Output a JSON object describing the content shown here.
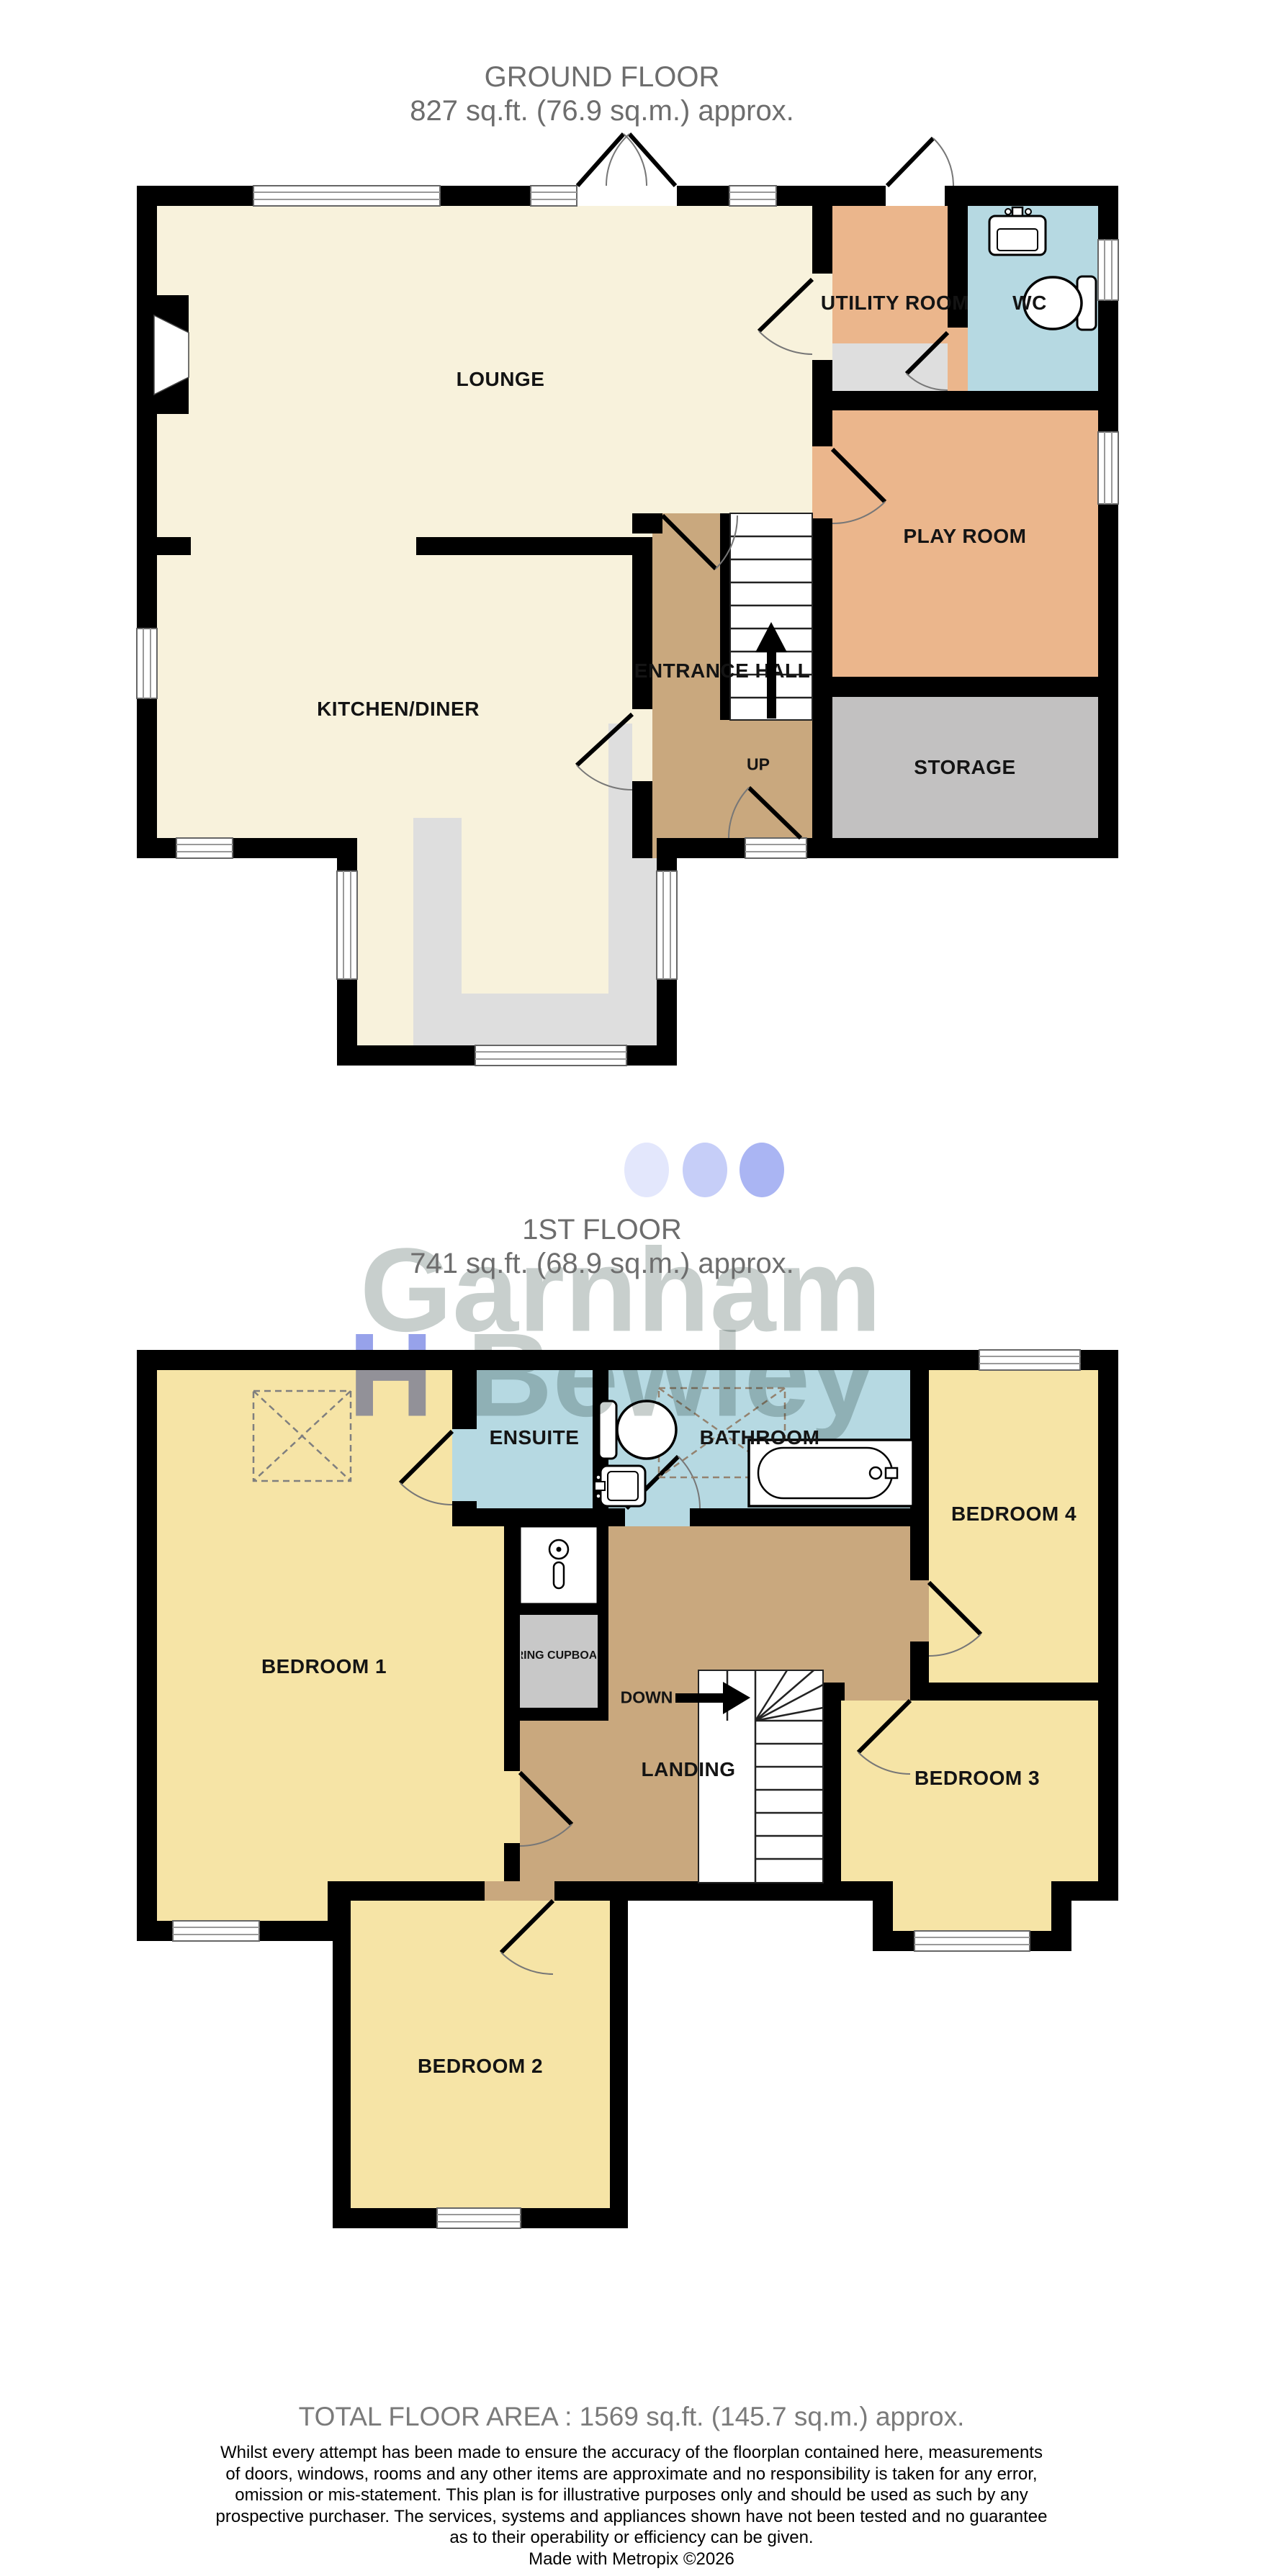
{
  "ground_floor": {
    "title": "GROUND FLOOR",
    "area": "827 sq.ft. (76.9 sq.m.) approx.",
    "rooms": {
      "lounge": "LOUNGE",
      "kitchen": "KITCHEN/DINER",
      "utility": "UTILITY ROOM",
      "wc": "WC",
      "play": "PLAY ROOM",
      "storage": "STORAGE",
      "hall": "ENTRANCE HALL",
      "up": "UP"
    }
  },
  "first_floor": {
    "title": "1ST FLOOR",
    "area": "741 sq.ft. (68.9 sq.m.) approx.",
    "rooms": {
      "bedroom1": "BEDROOM 1",
      "ensuite": "ENSUITE",
      "bathroom": "BATHROOM",
      "bedroom4": "BEDROOM 4",
      "airing": "AIRING CUPBOARD",
      "landing": "LANDING",
      "down": "DOWN",
      "bedroom3": "BEDROOM 3",
      "bedroom2": "BEDROOM 2"
    }
  },
  "watermark": {
    "line1": "Garnham",
    "line2_initial": "H",
    "line2_rest": "Bewley"
  },
  "footer": {
    "total": "TOTAL FLOOR AREA : 1569 sq.ft. (145.7 sq.m.) approx.",
    "disclaimer": [
      "Whilst every attempt has been made to ensure the accuracy of the floorplan contained here, measurements",
      "of doors, windows, rooms and any other items are approximate and no responsibility is taken for any error,",
      "omission or mis-statement. This plan is for illustrative purposes only and should be used as such by any",
      "prospective purchaser. The services, systems and appliances shown have not been tested and no guarantee",
      "as to their operability or efficiency can be given.",
      "Made with Metropix ©2026"
    ]
  },
  "colors": {
    "wall": "#000000",
    "cream": "#F8F2DC",
    "orange": "#EBB68C",
    "tan": "#C9A87E",
    "blue": "#B6D9E2",
    "yellow": "#F6E4A6",
    "storage_gray": "#C2C1C1",
    "counter_gray": "#DEDEDE",
    "title_gray": "#6d6d6d",
    "watermark_gray": "#c3cbc9",
    "watermark_blue": "#8e9ae9"
  }
}
